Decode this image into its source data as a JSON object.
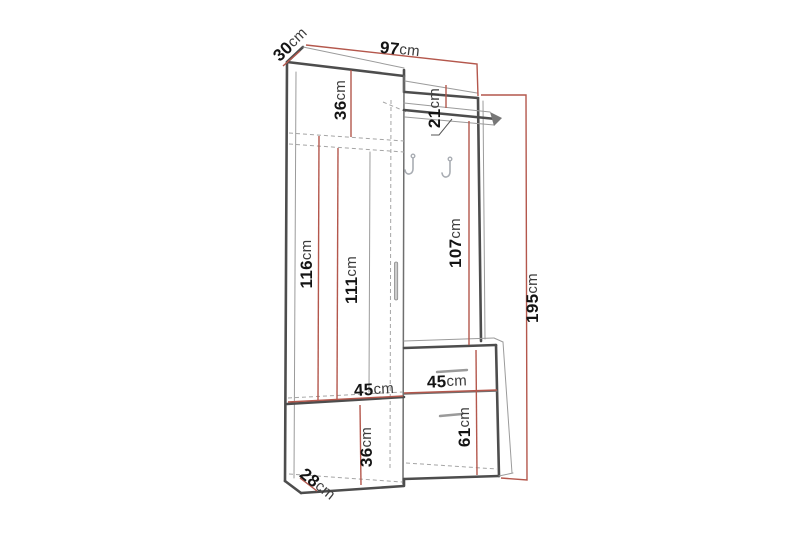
{
  "diagram": {
    "kind": "furniture-dimension-diagram",
    "subject": "hallway wardrobe unit with coat panel, shelf, hooks, drawer and cabinets",
    "unit": "cm",
    "dimension_line_color": "#b4574c",
    "outline_color": "#4d4d4d",
    "background_color": "#ffffff"
  },
  "dims": {
    "depth_top": {
      "value": "30",
      "unit": "cm"
    },
    "total_width": {
      "value": "97",
      "unit": "cm"
    },
    "upper_section_height": {
      "value": "36",
      "unit": "cm"
    },
    "shelf_drop": {
      "value": "21",
      "unit": "cm"
    },
    "left_inner_height": {
      "value": "116",
      "unit": "cm"
    },
    "left_door_height": {
      "value": "111",
      "unit": "cm"
    },
    "panel_height": {
      "value": "107",
      "unit": "cm"
    },
    "total_height": {
      "value": "195",
      "unit": "cm"
    },
    "left_section_width": {
      "value": "45",
      "unit": "cm"
    },
    "right_cabinet_width": {
      "value": "45",
      "unit": "cm"
    },
    "bottom_door_height": {
      "value": "36",
      "unit": "cm"
    },
    "right_cabinet_height": {
      "value": "61",
      "unit": "cm"
    },
    "base_depth": {
      "value": "28",
      "unit": "cm"
    }
  }
}
